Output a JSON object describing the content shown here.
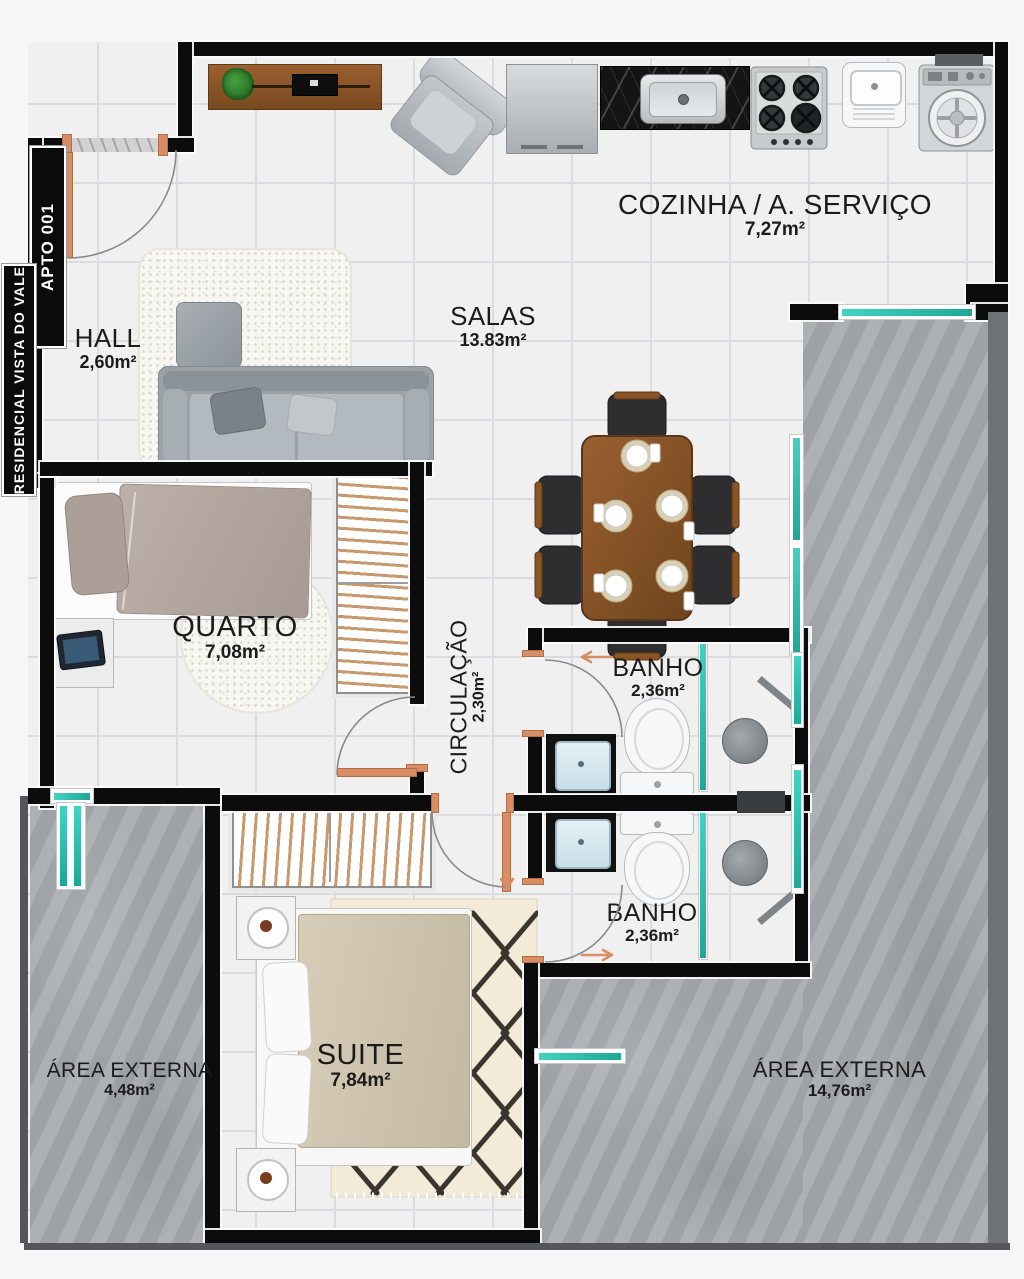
{
  "plan": {
    "apto_tag": "APTO 001",
    "residencial_tag": "RESIDENCIAL VISTA DO VALE",
    "rooms": [
      {
        "name": "COZINHA / A. SERVIÇO",
        "area": "7,27m²"
      },
      {
        "name": "SALAS",
        "area": "13.83m²"
      },
      {
        "name": "HALL",
        "area": "2,60m²"
      },
      {
        "name": "QUARTO",
        "area": "7,08m²"
      },
      {
        "name": "CIRCULAÇÃO",
        "area": "2,30m²"
      },
      {
        "name": "BANHO",
        "area": "2,36m²"
      },
      {
        "name": "BANHO",
        "area": "2,36m²"
      },
      {
        "name": "SUITE",
        "area": "7,84m²"
      },
      {
        "name": "ÁREA EXTERNA",
        "area": "4,48m²"
      },
      {
        "name": "ÁREA EXTERNA",
        "area": "14,76m²"
      }
    ],
    "colors": {
      "wall": "#0c0c0c",
      "window": "#2fc1b1",
      "door": "#d98d64",
      "floor": "#f0f0f1",
      "exterior_concrete": "#a7abaf",
      "wood": "#8a5426",
      "label_text": "#1b1b1b"
    }
  }
}
